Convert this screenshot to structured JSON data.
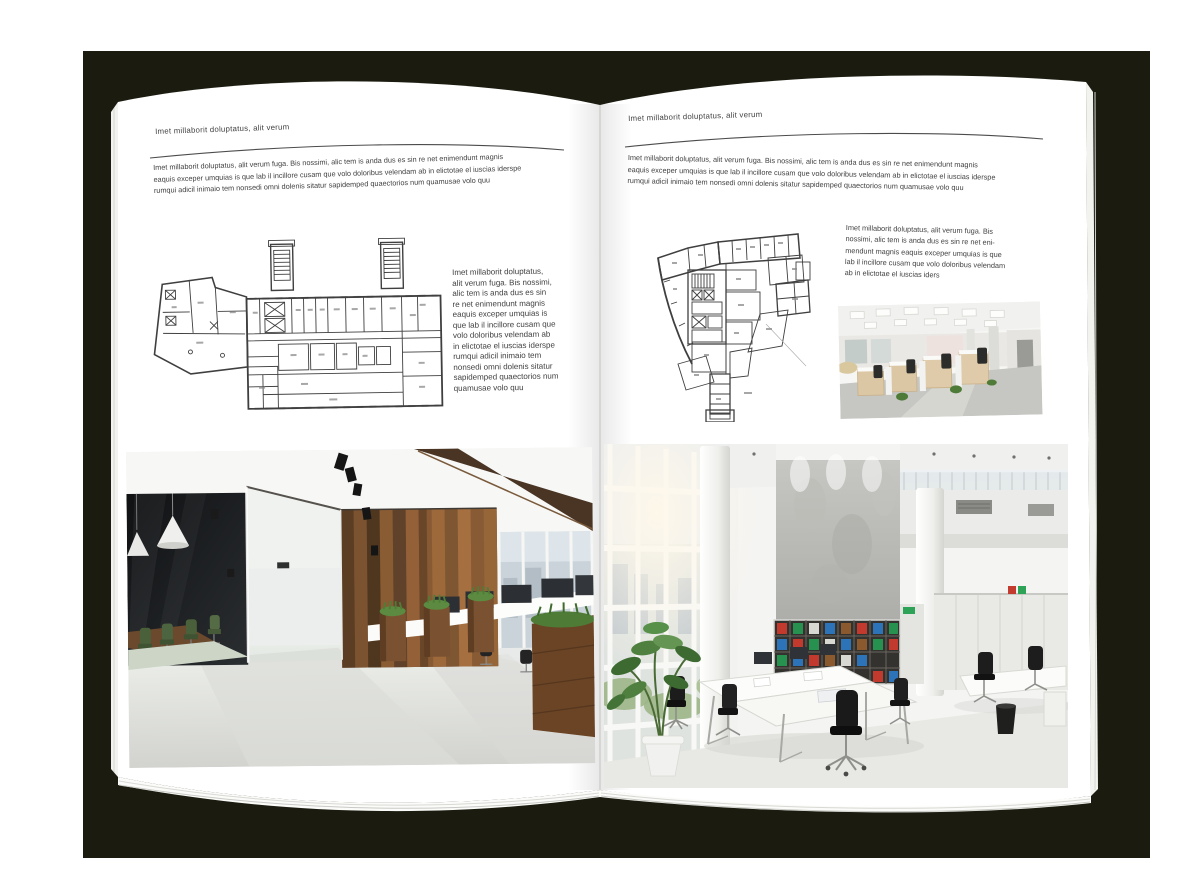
{
  "mockup": {
    "type": "open-brochure-spread",
    "backdrop_color": "#1b1c0f",
    "paper_color": "#ffffff",
    "text_color": "#3f3f3f",
    "rule_color": "#4c4c4c",
    "plan_ink_color": "#3f3f3f"
  },
  "left_page": {
    "header": "Imet millaborit doluptatus, alit verum",
    "intro_lines": [
      "Imet millaborit doluptatus, alit verum fuga. Bis nossimi, alic tem is anda dus es sin re net enimendunt magnis",
      "eaquis exceper umquias is que lab il incillore cusam que volo doloribus velendam ab in elictotae el iuscias iderspe",
      "rumqui adicil inimaio tem nonsedi omni dolenis sitatur sapidemped quaectorios num quamusae volo quu"
    ],
    "side_lines": [
      "Imet millaborit doluptatus,",
      "alit verum fuga. Bis nossimi,",
      "alic tem is anda dus es sin",
      "re net enimendunt magnis",
      "eaquis exceper umquias is",
      "que lab il incillore cusam que",
      "volo doloribus velendam ab",
      "in elictotae el iuscias iderspe",
      "rumqui adicil inimaio tem",
      "nonsedi omni dolenis sitatur",
      "sapidemped quaectorios num",
      "quamusae volo quu"
    ],
    "figures": {
      "floor_plan": "architectural floor plan, wide building with two stair towers",
      "photo": "office interior with glass meeting room, green chairs and wood wall"
    }
  },
  "right_page": {
    "header": "Imet millaborit doluptatus, alit verum",
    "intro_lines": [
      "Imet millaborit doluptatus, alit verum fuga. Bis nossimi, alic tem is anda dus es sin re net enimendunt magnis",
      "eaquis exceper umquias is que lab il incillore cusam que volo doloribus velendam ab in elictotae el iuscias iderspe",
      "rumqui adicil inimaio tem nonsedi omni dolenis sitatur sapidemped quaectorios num quamusae volo quu"
    ],
    "side_lines": [
      "Imet millaborit doluptatus, alit verum fuga. Bis",
      "nossimi, alic tem is anda dus es sin re net eni-",
      "mendunt magnis eaquis exceper umquias is que",
      "lab il incillore cusam que volo doloribus velendam",
      "ab in elictotae el iuscias iders"
    ],
    "figures": {
      "floor_plan": "architectural floor plan, irregular tower footprint",
      "photo_small": "open-plan office with cubicle workstations",
      "photo_large": "bright double-height office atrium with bookshelves and white desks"
    }
  },
  "photo_palette": {
    "wood": "#7b5231",
    "dark_glass": "#17181c",
    "chair_green": "#49603a",
    "concrete": "#bcbcb8",
    "binder_red": "#c2392e",
    "binder_green": "#27924f",
    "binder_blue": "#2c73b8",
    "exit_green": "#2ea357",
    "floor_gray": "#d8d9d5"
  }
}
